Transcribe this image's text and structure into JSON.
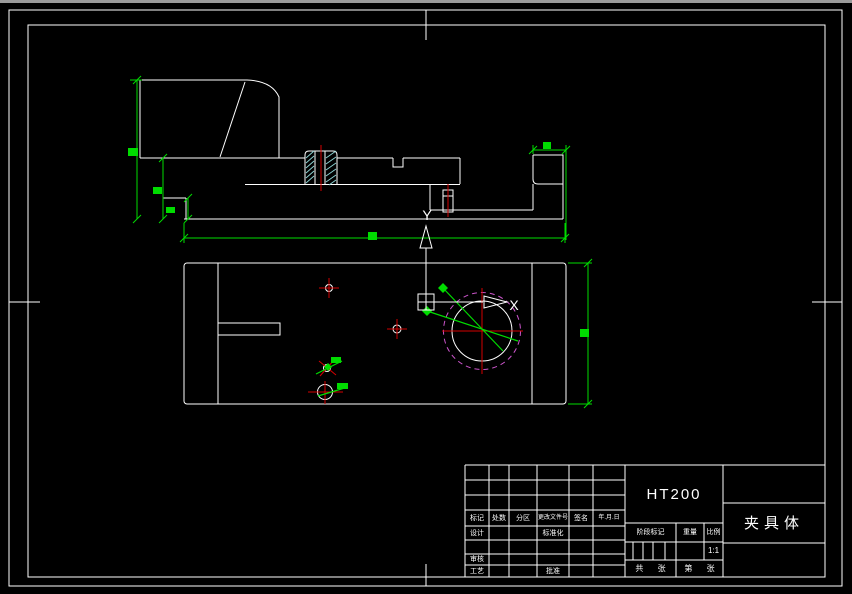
{
  "title_block": {
    "material": "HT200",
    "part_name": "夹具体",
    "header_cols": [
      "标记",
      "处数",
      "分区",
      "更改文件号",
      "签名",
      "年.月.日"
    ],
    "design": "设计",
    "standardize": "标准化",
    "audit": "审核",
    "craft": "工艺",
    "approve": "批准",
    "stage_mark": "阶段标记",
    "weight": "重量",
    "scale_label": "比例",
    "scale_value": "1:1",
    "sheet_total": "共 张",
    "sheet_no": "第 张"
  },
  "ucs": {
    "x": "X",
    "y": "Y"
  },
  "colors": {
    "bg": "#000000",
    "line": "#ffffff",
    "dim": "#00dc00",
    "center": "#d40000",
    "phantom": "#cc55cc",
    "hatch": "#8ed6d6",
    "edge": "#9a9a9a"
  }
}
